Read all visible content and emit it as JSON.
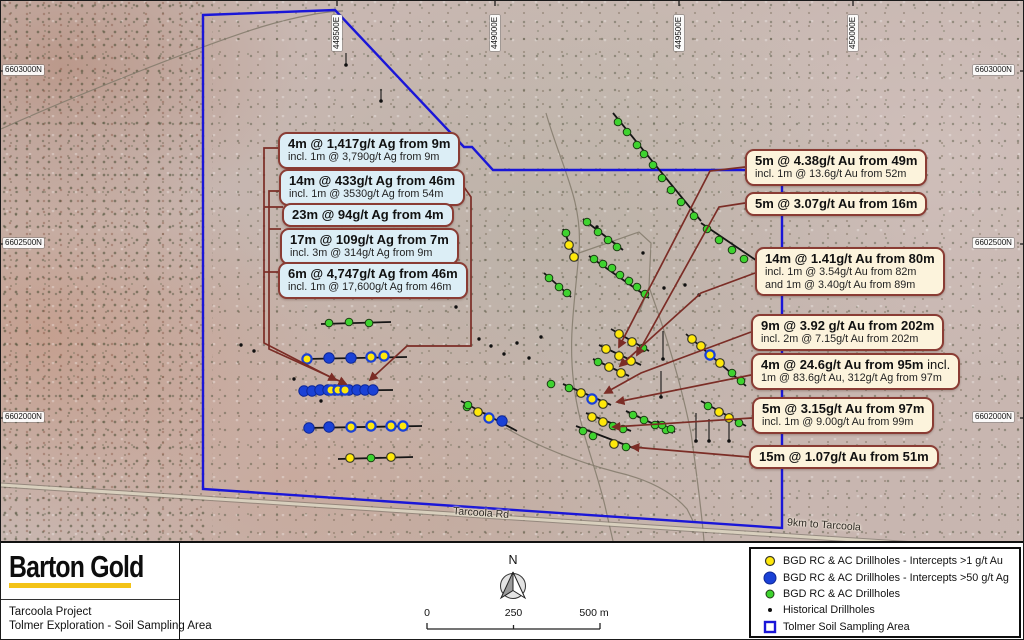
{
  "title": "Tolmer Exploration - Soil Sampling Area map",
  "colors": {
    "boundary_blue": "#1a16d8",
    "callout_border": "#8a3c34",
    "silver_callout_bg": "#dceef6",
    "gold_callout_bg": "#fcf3dc",
    "leader_red": "#7b2d26",
    "dot_yellow": "#ffe80a",
    "dot_blue": "#1a41d6",
    "dot_green": "#3ed32f",
    "logo_underline": "#f3c317"
  },
  "map": {
    "road_label": "Tarcoola Rd",
    "road_note": "9km to Tarcoola",
    "grid_top": [
      {
        "text": "448500E",
        "x": 336
      },
      {
        "text": "449000E",
        "x": 494
      },
      {
        "text": "449500E",
        "x": 678
      },
      {
        "text": "450000E",
        "x": 852
      }
    ],
    "grid_left": [
      {
        "text": "6603000N",
        "y": 70
      },
      {
        "text": "6602500N",
        "y": 243
      },
      {
        "text": "6602000N",
        "y": 417
      }
    ],
    "grid_right": [
      {
        "text": "6603000N",
        "y": 70
      },
      {
        "text": "6602500N",
        "y": 243
      },
      {
        "text": "6602000N",
        "y": 417
      }
    ],
    "callouts_silver": [
      {
        "title": "4m @ 1,417g/t Ag from 9m",
        "sub": "incl. 1m @ 3,790g/t Ag from 9m"
      },
      {
        "title": "14m @ 433g/t Ag from 46m",
        "sub": "incl. 1m @ 3530g/t Ag from 54m"
      },
      {
        "title": "23m @ 94g/t Ag from 4m"
      },
      {
        "title": "17m @ 109g/t Ag from 7m",
        "sub": "incl. 3m @ 314g/t Ag from 9m"
      },
      {
        "title": "6m @ 4,747g/t Ag from 46m",
        "sub": "incl. 1m @ 17,600g/t Ag from 46m"
      }
    ],
    "callouts_gold": [
      {
        "title": "5m @ 4.38g/t Au from 49m",
        "sub": "incl. 1m @ 13.6g/t Au from 52m"
      },
      {
        "title": "5m @ 3.07g/t Au from 16m"
      },
      {
        "title": "14m @ 1.41g/t Au from 80m",
        "sub": "incl. 1m @ 3.54g/t Au from 82m",
        "sub2": "and 1m @ 3.40g/t Au from 89m"
      },
      {
        "title": "9m @ 3.92 g/t Au from 202m",
        "sub": "incl. 2m @ 7.15g/t Au from 202m"
      },
      {
        "title": "4m @ 24.6g/t Au from 95m",
        "tail": " incl.",
        "sub": "1m @ 83.6g/t Au, 312g/t Ag from 97m"
      },
      {
        "title": "5m @ 3.15g/t Au from 97m",
        "sub": "incl. 1m @ 9.00g/t Au from 99m"
      },
      {
        "title": "15m @ 1.07g/t Au from 51m"
      }
    ]
  },
  "footer": {
    "logo": "Barton Gold",
    "project_line1": "Tarcoola Project",
    "project_line2": "Tolmer Exploration - Soil Sampling Area",
    "north_label": "N",
    "scale": {
      "start": "0",
      "mid": "250",
      "end": "500 m"
    },
    "legend": [
      {
        "symbol": "yellow-dot",
        "label": "BGD RC & AC Drillholes - Intercepts >1 g/t Au"
      },
      {
        "symbol": "blue-dot",
        "label": "BGD RC & AC Drillholes - Intercepts >50 g/t Ag"
      },
      {
        "symbol": "green-dot",
        "label": "BGD RC & AC Drillholes"
      },
      {
        "symbol": "black-dot",
        "label": "Historical Drillholes"
      },
      {
        "symbol": "blue-square",
        "label": "Tolmer Soil Sampling Area"
      }
    ]
  },
  "map_geometry": {
    "polygon": "202,14 334,9 463,146 471,146 492,169 781,169 781,527 202,488",
    "road": "M0,484 L1024,550",
    "tracks": [
      "M0,128 C80,92 200,45 260,26 C300,14 330,10 342,10",
      "M545,112 C560,165 582,200 578,250 C574,302 566,340 574,392 C580,432 596,470 604,505 L612,540",
      "M578,252 L638,231 L650,242 L648,286 L638,312",
      "M648,286 C664,330 680,382 690,432 C695,468 700,505 703,540",
      "M505,427 C545,450 585,463 615,471 C650,479 672,492 686,508 L692,520"
    ],
    "fences": [
      [
        320,
        323,
        390,
        321
      ],
      [
        304,
        358,
        406,
        356
      ],
      [
        299,
        390,
        392,
        389
      ],
      [
        303,
        427,
        421,
        425
      ],
      [
        337,
        458,
        412,
        456
      ],
      [
        612,
        112,
        700,
        220
      ],
      [
        700,
        222,
        768,
        268
      ],
      [
        582,
        218,
        622,
        249
      ],
      [
        588,
        255,
        648,
        297
      ],
      [
        562,
        228,
        576,
        260
      ],
      [
        543,
        272,
        570,
        296
      ],
      [
        610,
        328,
        648,
        350
      ],
      [
        598,
        344,
        640,
        364
      ],
      [
        592,
        358,
        628,
        375
      ],
      [
        562,
        383,
        610,
        404
      ],
      [
        685,
        333,
        745,
        385
      ],
      [
        700,
        400,
        745,
        425
      ],
      [
        585,
        412,
        630,
        430
      ],
      [
        625,
        410,
        672,
        432
      ],
      [
        575,
        425,
        635,
        448
      ],
      [
        460,
        400,
        516,
        430
      ],
      [
        656,
        420,
        674,
        431
      ]
    ],
    "leaders": [
      "M277,147 H263 V342 L335,379",
      "M279,190 H268 V348 L345,383",
      "M446,162 L470,196 V345 H406 L369,379",
      "M744,166 L709,170 L618,346",
      "M744,202 L718,206 L636,354",
      "M754,272 L700,292 L619,365",
      "M750,331 L640,372 L604,392",
      "M750,374 L616,401",
      "M751,417 L612,426",
      "M748,456 L631,446"
    ],
    "leader_stubs": [
      "M282,206 H263",
      "M280,228 H268",
      "M278,271 H263"
    ],
    "markers": {
      "green": [
        [
          328,
          322
        ],
        [
          348,
          321
        ],
        [
          368,
          322
        ],
        [
          370,
          457
        ],
        [
          466,
          406
        ],
        [
          617,
          121
        ],
        [
          626,
          131
        ],
        [
          636,
          144
        ],
        [
          643,
          153
        ],
        [
          652,
          164
        ],
        [
          661,
          177
        ],
        [
          670,
          189
        ],
        [
          680,
          201
        ],
        [
          693,
          215
        ],
        [
          706,
          228
        ],
        [
          718,
          239
        ],
        [
          731,
          249
        ],
        [
          743,
          258
        ],
        [
          586,
          221
        ],
        [
          597,
          231
        ],
        [
          607,
          239
        ],
        [
          616,
          246
        ],
        [
          593,
          258
        ],
        [
          602,
          263
        ],
        [
          611,
          267
        ],
        [
          619,
          274
        ],
        [
          628,
          280
        ],
        [
          636,
          286
        ],
        [
          644,
          293
        ],
        [
          565,
          232
        ],
        [
          548,
          277
        ],
        [
          558,
          286
        ],
        [
          566,
          292
        ],
        [
          642,
          347
        ],
        [
          597,
          361
        ],
        [
          568,
          387
        ],
        [
          731,
          372
        ],
        [
          740,
          380
        ],
        [
          707,
          405
        ],
        [
          738,
          422
        ],
        [
          612,
          425
        ],
        [
          622,
          428
        ],
        [
          632,
          414
        ],
        [
          643,
          419
        ],
        [
          654,
          424
        ],
        [
          665,
          429
        ],
        [
          582,
          430
        ],
        [
          592,
          435
        ],
        [
          625,
          446
        ],
        [
          467,
          404
        ],
        [
          661,
          424
        ],
        [
          670,
          428
        ],
        [
          550,
          383
        ]
      ],
      "yellow": [
        [
          349,
          457
        ],
        [
          390,
          456
        ],
        [
          568,
          244
        ],
        [
          573,
          256
        ],
        [
          618,
          333
        ],
        [
          631,
          341
        ],
        [
          605,
          348
        ],
        [
          618,
          355
        ],
        [
          630,
          360
        ],
        [
          608,
          366
        ],
        [
          620,
          372
        ],
        [
          580,
          392
        ],
        [
          602,
          403
        ],
        [
          691,
          338
        ],
        [
          700,
          345
        ],
        [
          719,
          362
        ],
        [
          718,
          411
        ],
        [
          728,
          417
        ],
        [
          591,
          416
        ],
        [
          602,
          421
        ],
        [
          613,
          443
        ],
        [
          477,
          411
        ]
      ],
      "yellowBlue": [
        [
          306,
          358
        ],
        [
          370,
          356
        ],
        [
          383,
          355
        ],
        [
          330,
          389
        ],
        [
          337,
          389
        ],
        [
          344,
          389
        ],
        [
          350,
          426
        ],
        [
          370,
          425
        ],
        [
          390,
          425
        ],
        [
          402,
          425
        ],
        [
          591,
          398
        ],
        [
          709,
          354
        ],
        [
          488,
          417
        ]
      ],
      "blue": [
        [
          328,
          357
        ],
        [
          350,
          357
        ],
        [
          303,
          390
        ],
        [
          311,
          390
        ],
        [
          319,
          389
        ],
        [
          327,
          389
        ],
        [
          334,
          389
        ],
        [
          341,
          389
        ],
        [
          348,
          389
        ],
        [
          356,
          389
        ],
        [
          364,
          389
        ],
        [
          372,
          389
        ],
        [
          308,
          427
        ],
        [
          328,
          426
        ],
        [
          501,
          420
        ]
      ],
      "black": [
        [
          455,
          306
        ],
        [
          293,
          378
        ],
        [
          320,
          400
        ],
        [
          240,
          344
        ],
        [
          253,
          350
        ],
        [
          478,
          338
        ],
        [
          490,
          345
        ],
        [
          503,
          353
        ],
        [
          516,
          342
        ],
        [
          528,
          357
        ],
        [
          540,
          336
        ],
        [
          596,
          226
        ],
        [
          642,
          252
        ],
        [
          663,
          287
        ],
        [
          684,
          284
        ],
        [
          698,
          294
        ]
      ],
      "blackTail": [
        [
          345,
          52,
          64
        ],
        [
          380,
          88,
          100
        ],
        [
          662,
          330,
          358
        ],
        [
          695,
          412,
          440
        ],
        [
          708,
          418,
          440
        ],
        [
          728,
          412,
          440
        ],
        [
          660,
          370,
          396
        ]
      ]
    }
  }
}
